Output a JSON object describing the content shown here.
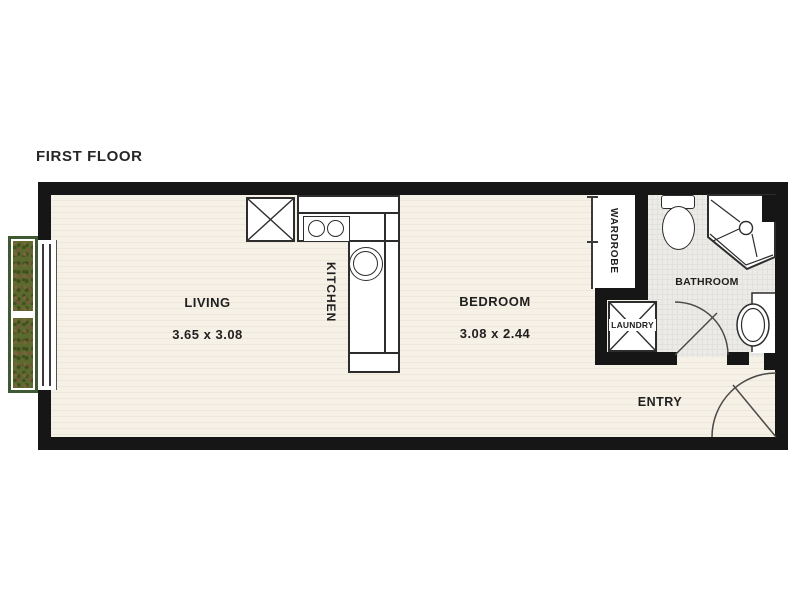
{
  "title": "FIRST FLOOR",
  "rooms": {
    "living": {
      "label": "LIVING",
      "dimensions": "3.65 x 3.08"
    },
    "kitchen": {
      "label": "KITCHEN"
    },
    "bedroom": {
      "label": "BEDROOM",
      "dimensions": "3.08 x 2.44"
    },
    "wardrobe": {
      "label": "WARDROBE"
    },
    "laundry": {
      "label": "LAUNDRY"
    },
    "bathroom": {
      "label": "BATHROOM"
    },
    "entry": {
      "label": "ENTRY"
    }
  },
  "colors": {
    "wall": "#161616",
    "floor": "#f5efe3",
    "bathroom_floor": "#ecebe7",
    "line": "#2d2d2d",
    "planter_frame": "#3d5a33",
    "planter_fill": "#5c6a2f",
    "text": "#1f1f1f"
  },
  "fixtures": [
    "planter-box",
    "window",
    "fridge",
    "cooktop",
    "kitchen-sink",
    "wardrobe-sliding-door",
    "laundry-unit",
    "toilet",
    "shower",
    "vanity-basin",
    "bathroom-door",
    "entry-door"
  ]
}
